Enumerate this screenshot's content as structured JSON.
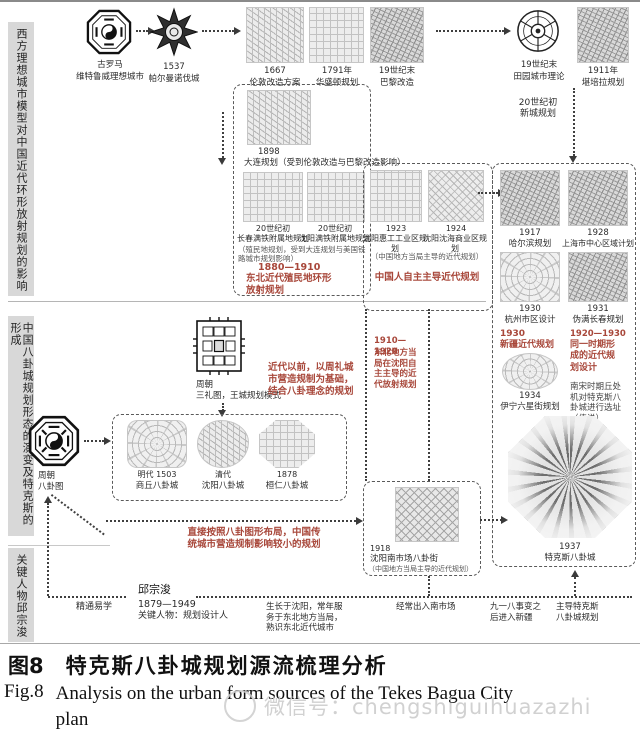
{
  "sidebar": {
    "s1": "西方理想城市模型对中国近代环形放射规划的影响",
    "s2": "中国八卦城规划形态的演变及特克斯的形成",
    "s3": "关键人物邱宗浚"
  },
  "top": {
    "rome": {
      "date": "古罗马",
      "label": "维特鲁威理想城市"
    },
    "palmanova": {
      "date": "1537",
      "label": "帕尔曼诺伐城"
    },
    "london": {
      "date": "1667",
      "label": "伦敦改造方案"
    },
    "washington": {
      "date": "1791年",
      "label": "华盛顿规划"
    },
    "paris": {
      "date": "19世纪末",
      "label": "巴黎改造"
    },
    "garden": {
      "date": "19世纪末",
      "label": "田园城市理论"
    },
    "canberra": {
      "date": "1911年",
      "label": "堪培拉规划"
    },
    "newtown": "20世纪初\n新城规划"
  },
  "colonial": {
    "dalian": {
      "date": "1898",
      "label": "大连规划（受到伦敦改造与巴黎改造影响）"
    },
    "changchun": {
      "date": "20世纪初",
      "label": "长春满铁附属地规划"
    },
    "shenyang": {
      "date": "20世纪初",
      "label": "沈阳满铁附属地规划"
    },
    "note": "（殖民地规划，受到大连规划与美国铁路城市规划影响）",
    "period": "1880—1910",
    "title": "东北近代殖民地环形放射规划"
  },
  "selfled": {
    "huigong": {
      "date": "1923",
      "label": "沈阳惠工工业区规划"
    },
    "shenhai": {
      "date": "1924",
      "label": "沈阳沈海商业区规划"
    },
    "note": "（中国地方当局主导的近代规划）",
    "title": "中国人自主主导近代规划",
    "radial_period": "1910—1920",
    "radial_title": "东北地方当局在沈阳自主主导的近代放射规划",
    "market": {
      "date": "1918",
      "label": "沈阳南市场八卦街",
      "note": "（中国地方当局主导的近代规划）"
    }
  },
  "rightpanel": {
    "harbin": {
      "date": "1917",
      "label": "哈尔滨规划"
    },
    "shanghai": {
      "date": "1928",
      "label": "上海市中心区域计划"
    },
    "hangzhou": {
      "date": "1930",
      "label": "杭州市区设计"
    },
    "changchun31": {
      "date": "1931",
      "label": "伪满长春规划"
    },
    "xinjiang_period": "1930",
    "xinjiang_title": "新疆近代规划",
    "yining": {
      "date": "1934",
      "label": "伊宁六星街规划"
    },
    "same_period": "1920—1930",
    "same_title": "同一时期形成的近代规划设计",
    "legend": "南宋时期丘处机对特克斯八卦城进行选址（传说）",
    "tekes": {
      "date": "1937",
      "label": "特克斯八卦城"
    }
  },
  "bagua": {
    "sanli": {
      "date": "周朝",
      "label": "三礼图，王城规划模式"
    },
    "premodern": "近代以前，以周礼城市营造规制为基础，结合八卦理念的规划",
    "diagram": {
      "date": "周朝",
      "label": "八卦图"
    },
    "shangqiu": {
      "date": "明代 1503",
      "label": "商丘八卦城"
    },
    "shenyang": {
      "date": "清代",
      "label": "沈阳八卦城"
    },
    "huanren": {
      "date": "1878",
      "label": "桓仁八卦城"
    },
    "direct": "直接按照八卦图形布局，中国传统城市营造规制影响较小的规划"
  },
  "person": {
    "yixue": "精通易学",
    "name": "邱宗浚",
    "years": "1879—1949",
    "role": "关键人物：规划设计人",
    "grow": "生长于沈阳，常年服务于东北地方当局，熟识东北近代城市",
    "market": "经常出入南市场",
    "incident": "九一八事变之后进入新疆",
    "lead": "主导特克斯八卦城规划"
  },
  "caption": {
    "zh_tag": "图8",
    "zh_title": "特克斯八卦城规划源流梳理分析",
    "en_tag": "Fig.8",
    "en_line1": "Analysis on the urban form sources of the Tekes Bagua City",
    "en_line2": "plan",
    "watermark": "微信号：chengshiguihuazazhi"
  },
  "colors": {
    "accent_red": "#a8473a",
    "sidebar_bg": "#d8d8d8"
  }
}
